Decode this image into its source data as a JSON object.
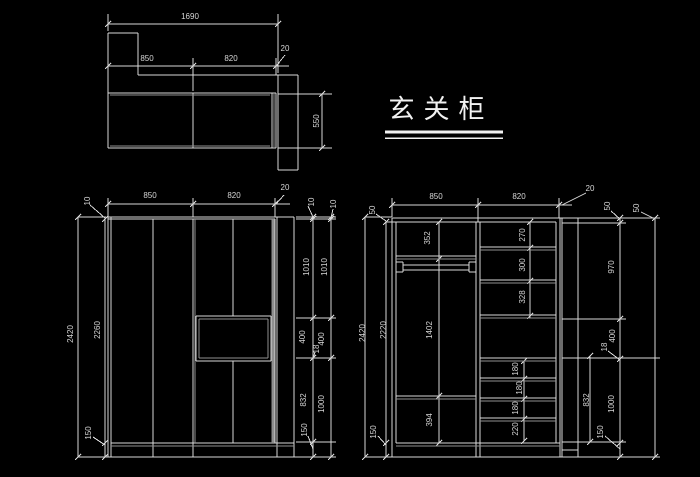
{
  "title": {
    "text": "玄关柜"
  },
  "plan": {
    "dim_total": "1690",
    "dim_left": "850",
    "dim_right": "820",
    "dim_gap": "20",
    "dim_depth": "550"
  },
  "front": {
    "dim_top_left": "850",
    "dim_top_right": "820",
    "dim_top_gap": "20",
    "left": {
      "overall": "2420",
      "inner": "2260",
      "top": "10",
      "bottom": "150"
    },
    "right_inner": {
      "top": "10",
      "upper": "1010",
      "drawer": "400",
      "shelf": "18",
      "lower": "832",
      "plinth": "150"
    },
    "right_outer": {
      "top": "10",
      "upper": "1010",
      "drawer": "400",
      "lower": "1000"
    }
  },
  "internal": {
    "dim_top_left": "850",
    "dim_top_right": "820",
    "dim_top_gap": "20",
    "left": {
      "overall": "2420",
      "inner": "2220",
      "top": "50",
      "bottom": "150"
    },
    "left_bay": {
      "upper": "352",
      "middle": "1402",
      "lower": "394"
    },
    "right_bay": {
      "s1": "270",
      "s2": "300",
      "s3": "328",
      "d1": "180",
      "d2": "180",
      "d3": "180",
      "d4": "220"
    },
    "right_dims": {
      "crown": "50",
      "upper": "970",
      "drawer": "400",
      "shelf": "18",
      "lower_combo": "1000",
      "plinth": "150",
      "hang": "832",
      "outer_crown": "50"
    }
  }
}
